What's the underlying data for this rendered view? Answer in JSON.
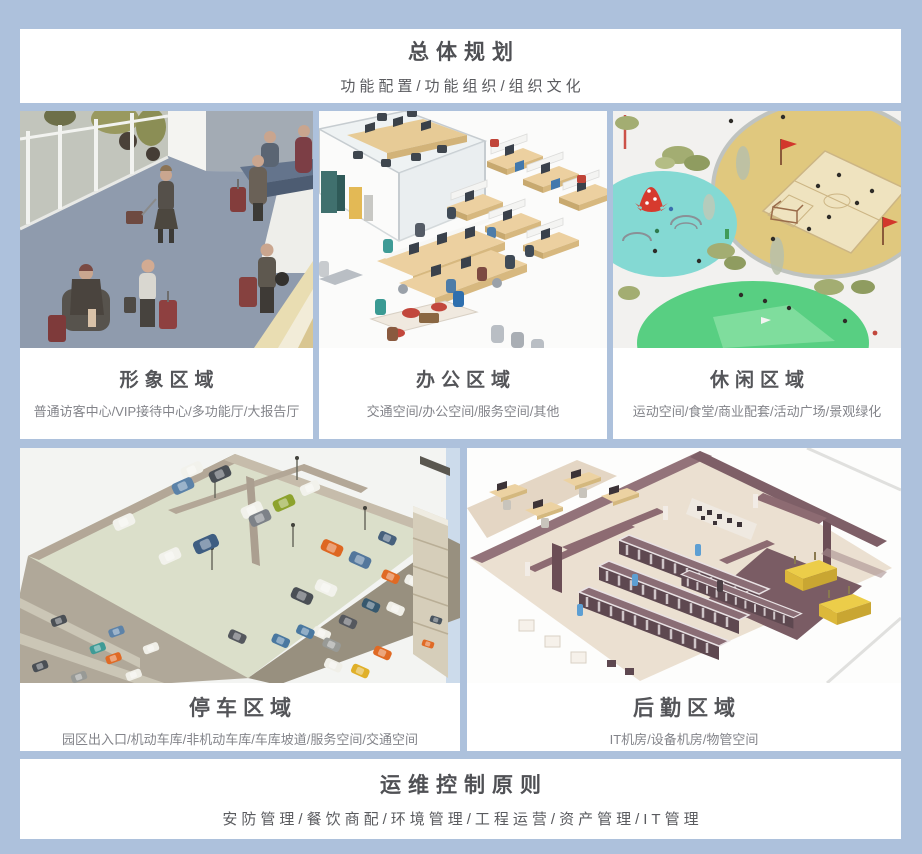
{
  "colors": {
    "background": "#adc1dc",
    "card": "#ffffff",
    "title_text": "#4f5054",
    "subtitle_text": "#83848a",
    "accent_red": "#d2372c",
    "accent_green": "#5ed184",
    "accent_teal": "#84d9d3",
    "accent_sand": "#e0c87e"
  },
  "header": {
    "title": "总体规划",
    "subtitle": "功能配置/功能组织/组织文化"
  },
  "zones": [
    {
      "title": "形象区域",
      "subtitle": "普通访客中心/VIP接待中心/多功能厅/大报告厅",
      "image": "reception-lobby-illustration"
    },
    {
      "title": "办公区域",
      "subtitle": "交通空间/办公空间/服务空间/其他",
      "image": "open-office-illustration"
    },
    {
      "title": "休闲区域",
      "subtitle": "运动空间/食堂/商业配套/活动广场/景观绿化",
      "image": "park-sports-illustration"
    },
    {
      "title": "停车区域",
      "subtitle": "园区出入口/机动车库/非机动车库/车库坡道/服务空间/交通空间",
      "image": "parking-garage-illustration"
    },
    {
      "title": "后勤区域",
      "subtitle": "IT机房/设备机房/物管空间",
      "image": "server-room-illustration"
    }
  ],
  "footer": {
    "title": "运维控制原则",
    "subtitle": "安防管理/餐饮商配/环境管理/工程运营/资产管理/IT管理"
  }
}
